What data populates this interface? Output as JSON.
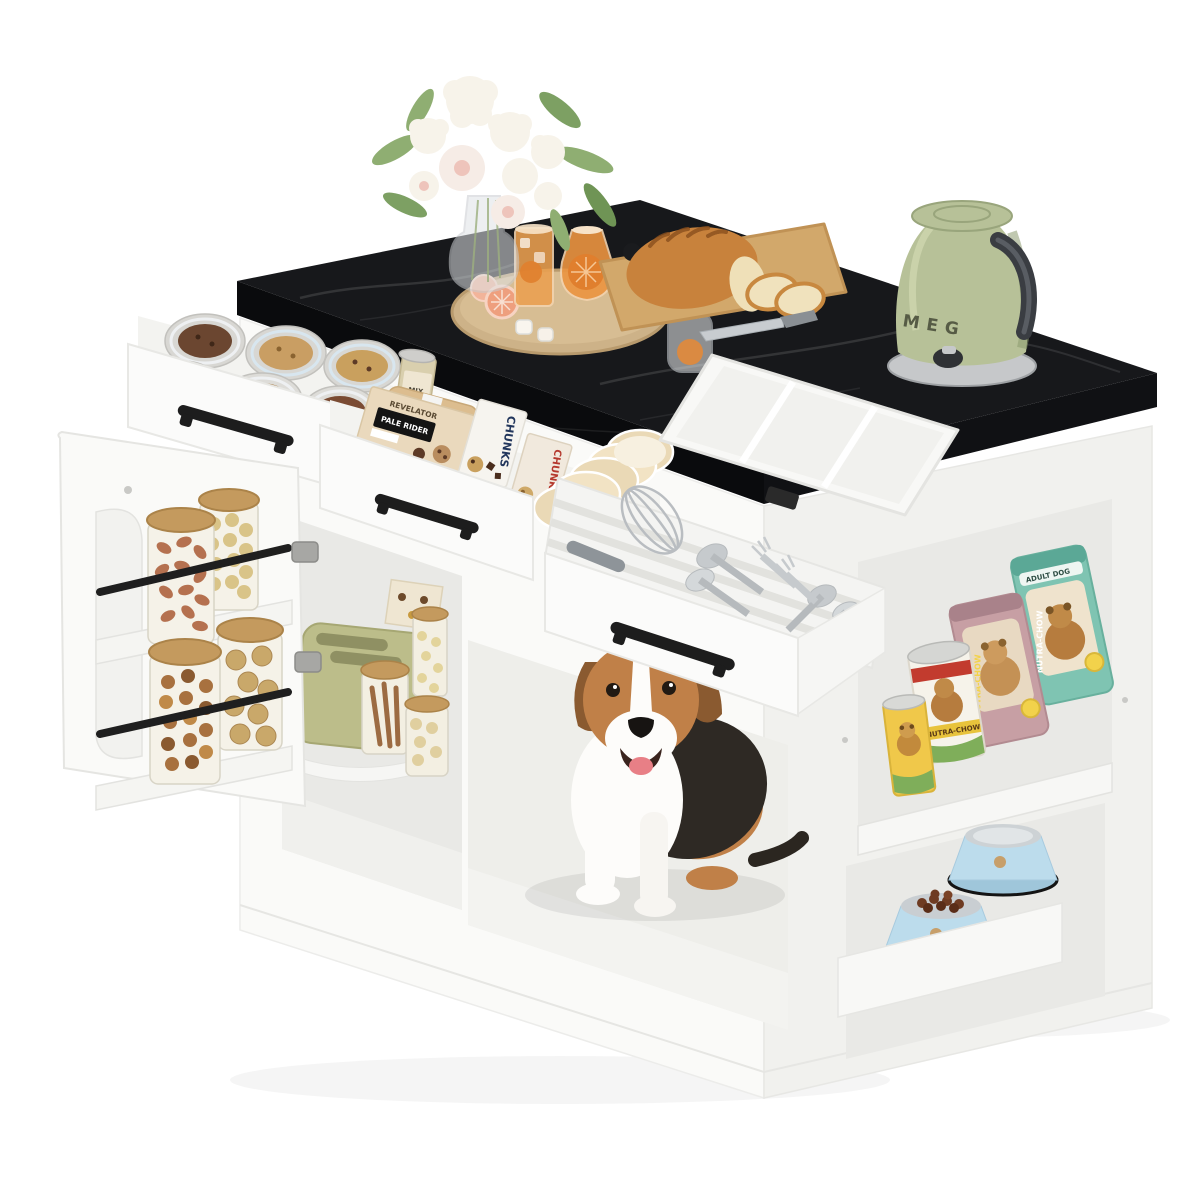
{
  "page": {
    "background": "#ffffff",
    "type": "product-photo",
    "subject": "White kitchen island with black marble top, open storage, pet nook with dog, and pet-feeding shelves"
  },
  "scene": {
    "colors": {
      "countertop": "#17181b",
      "cabinet": "#fafaf8",
      "sage_appliance": "#b7c198",
      "pet_bowl_blue": "#bcdcec",
      "wood": "#d2a86b",
      "handle_black": "#1d1d1d"
    },
    "objects": [
      "white-flower-bouquet-in-glass-vase",
      "round-wood-serving-board",
      "iced-orange-drink-glass",
      "orange-carafe",
      "grapefruit-halves",
      "ice-cubes",
      "stemless-glass-with-orange",
      "bamboo-cutting-board",
      "bread-loaf",
      "bread-slices",
      "knife",
      "white-expandable-cutlery-tray",
      "sage-green-electric-kettle",
      "drawer-of-cookie-tins",
      "drawer-of-cookie-boxes-and-cups",
      "open-cutlery-drawer-with-whisk-and-flatware",
      "open-door-spice-rack-with-nut-jars",
      "sage-green-toaster",
      "glass-pantry-jars",
      "beagle-dog-sitting-in-cubby",
      "dog-food-cans",
      "dog-food-bags",
      "kibble-bowl",
      "water-bowl"
    ]
  },
  "labels": {
    "kettle_text": "MEG",
    "box_brand": "REVELATOR",
    "box_name": "PALE RIDER",
    "chunks_navy": "CHUNKS",
    "chunks_red": "CHUNKS",
    "jar_mix": "MIX",
    "can_brand": "NUTRA-CHOW",
    "bag_mauve_brand": "NUTRA-CHOW",
    "bag_teal_brand": "NUTRA-CHOW",
    "bag_teal_badge": "ADULT DOG"
  }
}
